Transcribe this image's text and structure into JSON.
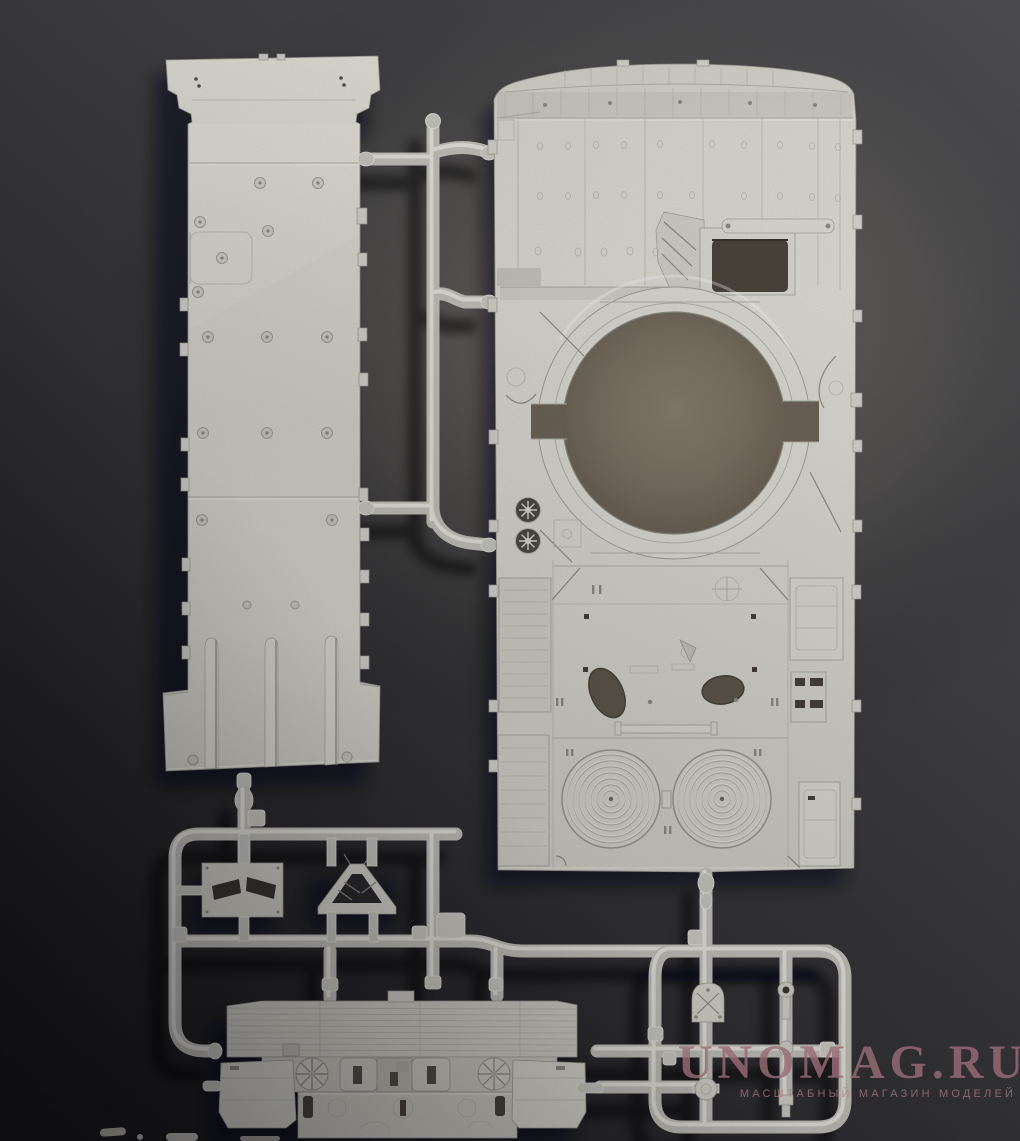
{
  "watermark": {
    "title": "UNOMAG.RU",
    "subtitle": "МАСШТАБНЫЙ МАГАЗИН МОДЕЛЕЙ",
    "title_color": "#9a6c76",
    "subtitle_color": "#aa7a82"
  },
  "photo": {
    "backdrop_dark": "#1d1d20",
    "backdrop_light": "#7b7264",
    "plastic_color": "#d9d8d0",
    "turret_opening_color": "#7c7365"
  }
}
